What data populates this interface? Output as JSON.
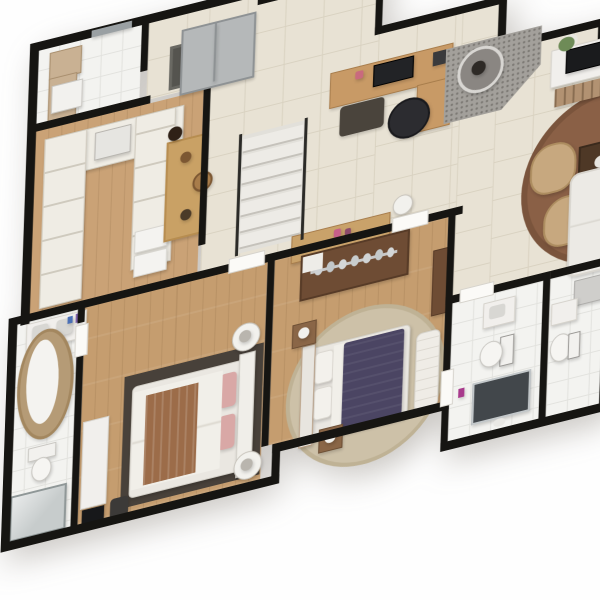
{
  "scene": {
    "kind": "3d-isometric-floor-plan-render",
    "background_color": "#ffffff",
    "wall_color": "#161512",
    "no_visible_text": true
  },
  "palette": {
    "beige_tile": "#e8e2d4",
    "white_tile": "#f3f3f0",
    "wood_floor": "#c59d6f",
    "dark_wood": "#6e4c34",
    "island_wood": "#c9a165",
    "rug_brown": "#8a6046",
    "rug_dark": "#48413a",
    "rug_beige": "#cdc1a8",
    "purple_duvet": "#4b4563",
    "tan_armchair": "#c7a87f",
    "fireplace_stone": "#a3a09b",
    "white_furniture": "#f1efec",
    "screen_black": "#1a1b1d",
    "pink_pillow": "#d9a8a6",
    "plant_green": "#6e8b57"
  },
  "rooms": [
    {
      "name": "laundry-room",
      "floor": "white-tile",
      "furniture": [
        "upper-cabinet",
        "counter",
        "laundry-sink",
        "sliding-door"
      ]
    },
    {
      "name": "entry-hall",
      "floor": "beige-tile",
      "furniture": [
        "doormat",
        "gray-storage-cabinet"
      ]
    },
    {
      "name": "walk-in-closet-pantry",
      "floor": "wood",
      "furniture": [
        "u-shaped-shelving",
        "folded-linen-stacks",
        "center-shelf-box",
        "white-bins"
      ]
    },
    {
      "name": "great-room",
      "floor": "beige-tile",
      "furniture": [
        "staircase-with-railings",
        "kitchen-office-counter",
        "monitor",
        "desk-chair",
        "dark-bench",
        "bar-counter-island",
        "bar-stool",
        "decor-statue",
        "fireplace-with-round-chimney",
        "tv-console",
        "flat-tv",
        "crate-shelf",
        "flower-vase",
        "round-brown-rug",
        "armchair-1",
        "armchair-2",
        "coffee-table",
        "white-sofa",
        "console-table",
        "floor-lamp",
        "pink-decor"
      ]
    },
    {
      "name": "master-bathroom",
      "floor": "white-tile",
      "furniture": [
        "double-vanity",
        "toiletries",
        "oval-stone-bathtub",
        "toilet",
        "shower"
      ]
    },
    {
      "name": "master-bedroom",
      "floor": "wood",
      "furniture": [
        "dark-area-rug",
        "double-bed-white-brown",
        "pink-pillows",
        "round-nightstand-north",
        "round-nightstand-south",
        "white-sideboard",
        "tv",
        "dark-chair"
      ]
    },
    {
      "name": "bedroom-2",
      "floor": "wood",
      "furniture": [
        "wardrobe-with-hangers",
        "round-beige-rug",
        "double-bed-purple",
        "white-pillows",
        "wood-nightstand-north",
        "wood-nightstand-south",
        "table-lamps",
        "quilted-bench",
        "tall-dresser"
      ]
    },
    {
      "name": "bathroom-2",
      "floor": "white-tile",
      "furniture": [
        "sink-vanity",
        "toilet",
        "dark-glass-shower",
        "magenta-bottle"
      ]
    },
    {
      "name": "bathroom-3",
      "floor": "white-tile",
      "furniture": [
        "vanity-counter",
        "sink",
        "toilet"
      ]
    }
  ]
}
